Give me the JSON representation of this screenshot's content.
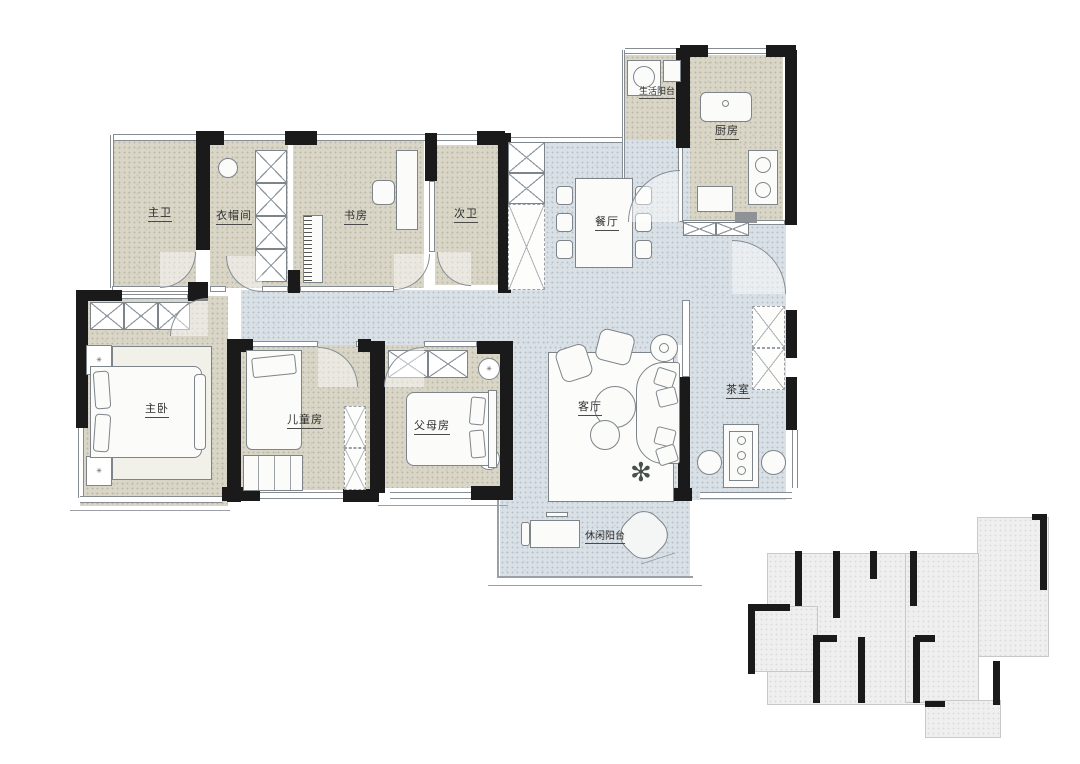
{
  "plan_title": "apartment-floor-plan",
  "colors": {
    "wall": "#1a1a1a",
    "floor_warm": "#d9d6c7",
    "floor_cool": "#dae1e6",
    "background": "#ffffff",
    "line": "#868d92"
  },
  "rooms": {
    "service_balcony": {
      "label": "生活阳台"
    },
    "kitchen": {
      "label": "厨房"
    },
    "master_bath": {
      "label": "主卫"
    },
    "cloakroom": {
      "label": "衣帽间"
    },
    "study": {
      "label": "书房"
    },
    "second_bath": {
      "label": "次卫"
    },
    "dining": {
      "label": "餐厅"
    },
    "tea_room": {
      "label": "茶室"
    },
    "master_bedroom": {
      "label": "主卧"
    },
    "children_room": {
      "label": "儿童房"
    },
    "parents_room": {
      "label": "父母房"
    },
    "living_room": {
      "label": "客厅"
    },
    "leisure_balcony": {
      "label": "休闲阳台"
    }
  }
}
